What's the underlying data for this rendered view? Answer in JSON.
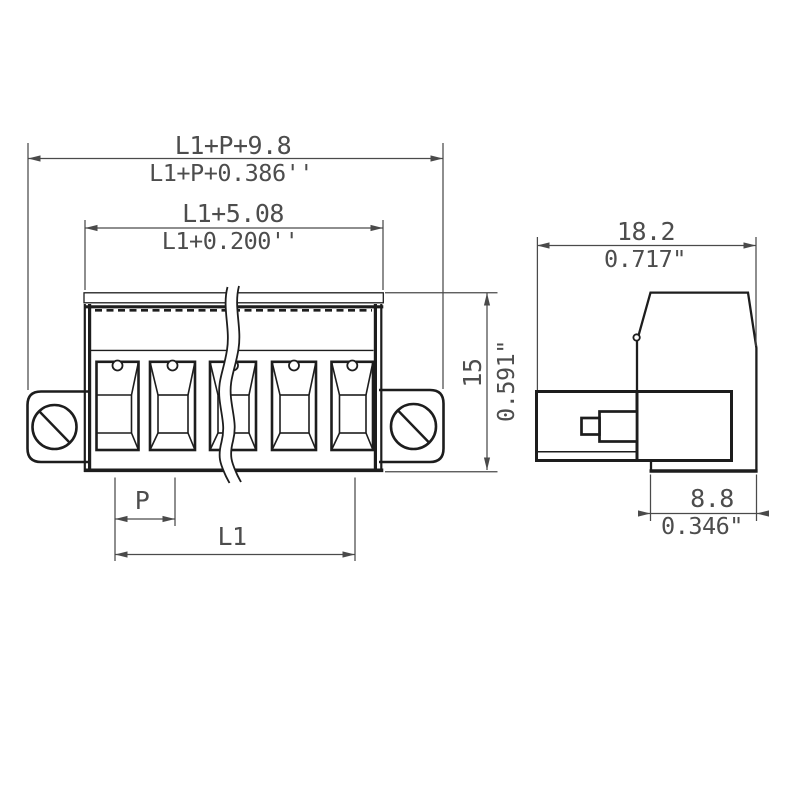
{
  "drawing": {
    "type": "technical-dimension-drawing",
    "views": {
      "front_view": "multi-pole terminal block with side mounting screw flanges, middle break lines",
      "side_view": "terminal block profile with plug pin"
    },
    "dims": {
      "total_mm": "L1+P+9.8",
      "total_in": "L1+P+0.386''",
      "body_mm": "L1+5.08",
      "body_in": "L1+0.200''",
      "height_mm": "15",
      "height_in": "0.591\"",
      "pitch": "P",
      "length": "L1",
      "side_width_mm": "18.2",
      "side_width_in": "0.717\"",
      "plug_depth_mm": "8.8",
      "plug_depth_in": "0.346\""
    },
    "colors": {
      "background": "#ffffff",
      "part_line": "#1d1d1d",
      "dimension_line": "#4a4a4a",
      "dimension_text": "#4d4d4d"
    }
  }
}
